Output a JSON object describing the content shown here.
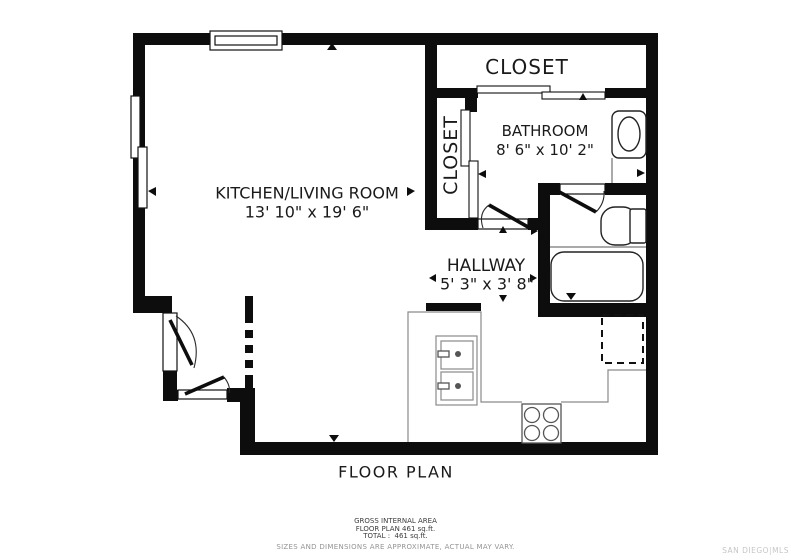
{
  "plan": {
    "rooms": {
      "closet_top": {
        "label": "CLOSET"
      },
      "closet_side": {
        "label": "CLOSET"
      },
      "bathroom": {
        "label": "BATHROOM",
        "dims": "8' 6\" x 10' 2\""
      },
      "kitchen_living": {
        "label": "KITCHEN/LIVING ROOM",
        "dims": "13' 10\" x 19' 6\""
      },
      "hallway": {
        "label": "HALLWAY",
        "dims": "5' 3\" x 3' 8\""
      }
    },
    "title": "FLOOR PLAN",
    "footer": {
      "line1": "GROSS INTERNAL AREA",
      "line2": "FLOOR PLAN 461 sq.ft.",
      "line3": "TOTAL :  461 sq.ft.",
      "line4": "SIZES AND DIMENSIONS ARE APPROXIMATE, ACTUAL MAY VARY."
    },
    "watermark": "SAN DIEGO|MLS",
    "areas": {
      "floor_plan_sqft": 461,
      "total_sqft": 461
    },
    "colors": {
      "wall": "#0d0d0d",
      "background": "#ffffff",
      "counter_line": "#8a8a8a",
      "watermark": "#c6c6c6"
    }
  }
}
